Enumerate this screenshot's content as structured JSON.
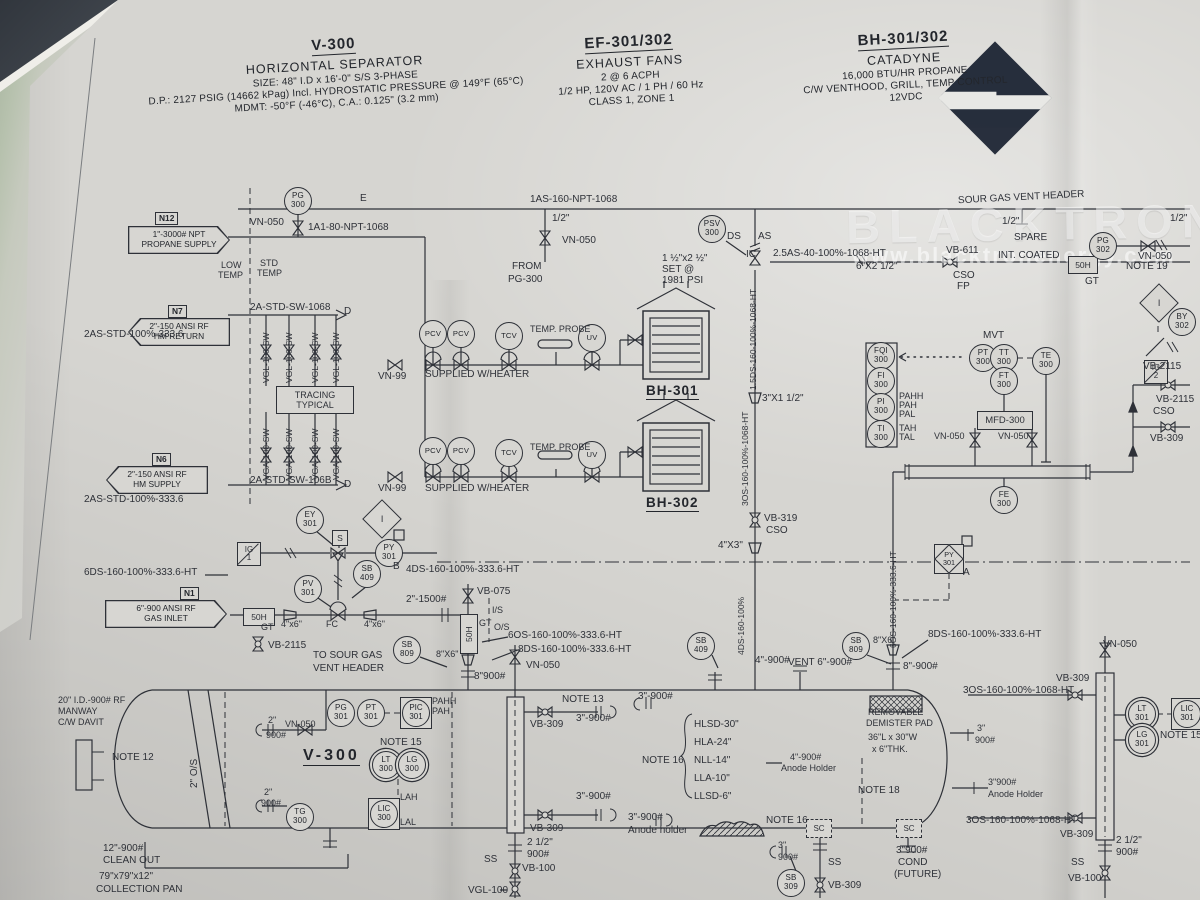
{
  "watermark": {
    "brand": "BLACKTRON",
    "url": "www.blacktronenergy.com"
  },
  "title_blocks": {
    "v300": {
      "tag": "V-300",
      "name": "HORIZONTAL SEPARATOR",
      "l1": "SIZE: 48\" I.D x 16'-0\" S/S 3-PHASE",
      "l2": "D.P.: 2127 PSIG (14662 kPag) Incl. HYDROSTATIC PRESSURE @ 149°F (65°C)",
      "l3": "MDMT: -50°F (-46°C), C.A.: 0.125\" (3.2 mm)"
    },
    "ef": {
      "tag": "EF-301/302",
      "name": "EXHAUST FANS",
      "l1": "2 @ 6 ACPH",
      "l2": "1/2 HP, 120V AC / 1 PH / 60 Hz",
      "l3": "CLASS 1, ZONE 1"
    },
    "bh": {
      "tag": "BH-301/302",
      "name": "CATADYNE",
      "l1": "16,000 BTU/HR PROPANE",
      "l2": "C/W VENTHOOD, GRILL, TEMP CONTROL",
      "l3": "12VDC"
    }
  },
  "equipment": {
    "bh301": "BH-301",
    "bh302": "BH-302",
    "v300": "V-300",
    "tracing_l1": "TRACING",
    "tracing_l2": "TYPICAL",
    "mfd": "MFD-300",
    "strainer": "50H",
    "ig": "IG",
    "ig1": "1",
    "ig2": "2",
    "interlock": "I",
    "solenoid": "S",
    "sc": "SC"
  },
  "flags": [
    {
      "id": "N12",
      "l1": "1\"-3000# NPT",
      "l2": "PROPANE SUPPLY",
      "x": 128,
      "y": 226,
      "w": 102,
      "dir": "right",
      "bx": 155,
      "by": 212
    },
    {
      "id": "N7",
      "l1": "2\"-150 ANSI RF",
      "l2": "HM RETURN",
      "x": 128,
      "y": 318,
      "w": 102,
      "dir": "left",
      "bx": 168,
      "by": 305
    },
    {
      "id": "N6",
      "l1": "2\"-150 ANSI RF",
      "l2": "HM SUPPLY",
      "x": 106,
      "y": 466,
      "w": 102,
      "dir": "left",
      "bx": 152,
      "by": 453
    },
    {
      "id": "N1",
      "l1": "6\"-900 ANSI RF",
      "l2": "GAS INLET",
      "x": 105,
      "y": 600,
      "w": 122,
      "dir": "right",
      "bx": 180,
      "by": 587
    }
  ],
  "instruments": [
    {
      "t": "PG",
      "n": "300",
      "x": 298,
      "y": 201
    },
    {
      "t": "PSV",
      "n": "300",
      "x": 712,
      "y": 229
    },
    {
      "t": "PG",
      "n": "302",
      "x": 1103,
      "y": 246
    },
    {
      "t": "BY",
      "n": "302",
      "x": 1182,
      "y": 322
    },
    {
      "t": "PCV",
      "x": 433,
      "y": 334,
      "s": "c1"
    },
    {
      "t": "PCV",
      "x": 461,
      "y": 334,
      "s": "c1"
    },
    {
      "t": "TCV",
      "x": 509,
      "y": 336,
      "s": "c1"
    },
    {
      "t": "UV",
      "x": 592,
      "y": 338,
      "s": "c1"
    },
    {
      "t": "PCV",
      "x": 433,
      "y": 451,
      "s": "c1"
    },
    {
      "t": "PCV",
      "x": 461,
      "y": 451,
      "s": "c1"
    },
    {
      "t": "TCV",
      "x": 509,
      "y": 453,
      "s": "c1"
    },
    {
      "t": "UV",
      "x": 592,
      "y": 455,
      "s": "c1"
    },
    {
      "t": "PT",
      "n": "300",
      "x": 983,
      "y": 358
    },
    {
      "t": "TT",
      "n": "300",
      "x": 1004,
      "y": 358
    },
    {
      "t": "TE",
      "n": "300",
      "x": 1046,
      "y": 361
    },
    {
      "t": "FT",
      "n": "300",
      "x": 1004,
      "y": 381
    },
    {
      "t": "FQI",
      "n": "300",
      "x": 881,
      "y": 356
    },
    {
      "t": "FI",
      "n": "300",
      "x": 881,
      "y": 381
    },
    {
      "t": "PI",
      "n": "300",
      "x": 881,
      "y": 407
    },
    {
      "t": "TI",
      "n": "300",
      "x": 881,
      "y": 434
    },
    {
      "t": "FE",
      "n": "300",
      "x": 1004,
      "y": 500
    },
    {
      "t": "EY",
      "n": "301",
      "x": 310,
      "y": 520
    },
    {
      "t": "PY",
      "n": "301",
      "x": 389,
      "y": 553
    },
    {
      "t": "PV",
      "n": "301",
      "x": 308,
      "y": 589
    },
    {
      "t": "SB",
      "n": "409",
      "x": 367,
      "y": 574
    },
    {
      "t": "SB",
      "n": "809",
      "x": 407,
      "y": 650
    },
    {
      "t": "SB",
      "n": "409",
      "x": 701,
      "y": 646
    },
    {
      "t": "SB",
      "n": "809",
      "x": 856,
      "y": 646
    },
    {
      "t": "PG",
      "n": "301",
      "x": 341,
      "y": 713
    },
    {
      "t": "PT",
      "n": "301",
      "x": 371,
      "y": 713
    },
    {
      "t": "PIC",
      "n": "301",
      "x": 416,
      "y": 713,
      "s": "sq"
    },
    {
      "t": "LT",
      "n": "300",
      "x": 386,
      "y": 765,
      "s": "dd"
    },
    {
      "t": "LG",
      "n": "300",
      "x": 412,
      "y": 765,
      "s": "dd"
    },
    {
      "t": "LIC",
      "n": "300",
      "x": 384,
      "y": 814,
      "s": "sq"
    },
    {
      "t": "TG",
      "n": "300",
      "x": 300,
      "y": 817
    },
    {
      "t": "SB",
      "n": "309",
      "x": 791,
      "y": 883
    },
    {
      "t": "LT",
      "n": "301",
      "x": 1142,
      "y": 714,
      "s": "dd"
    },
    {
      "t": "LG",
      "n": "301",
      "x": 1142,
      "y": 740,
      "s": "dd"
    },
    {
      "t": "LIC",
      "n": "301",
      "x": 1187,
      "y": 714,
      "s": "sq"
    },
    {
      "t": "PY",
      "n": "301",
      "x": 949,
      "y": 559,
      "s": "dm"
    }
  ],
  "labels": [
    {
      "t": "1AS-160-NPT-1068",
      "x": 530,
      "y": 195
    },
    {
      "t": "SOUR GAS VENT HEADER",
      "x": 958,
      "y": 193,
      "r": -3
    },
    {
      "t": "1/2\"",
      "x": 552,
      "y": 214
    },
    {
      "t": "VN-050",
      "x": 562,
      "y": 236
    },
    {
      "t": "FROM",
      "x": 512,
      "y": 262
    },
    {
      "t": "PG-300",
      "x": 508,
      "y": 275
    },
    {
      "t": "E",
      "x": 360,
      "y": 194
    },
    {
      "t": "1/2\"",
      "x": 1002,
      "y": 217
    },
    {
      "t": "SPARE",
      "x": 1014,
      "y": 233
    },
    {
      "t": "1/2\"",
      "x": 1170,
      "y": 214
    },
    {
      "t": "VN-050",
      "x": 1138,
      "y": 252
    },
    {
      "t": "DS",
      "x": 727,
      "y": 232
    },
    {
      "t": "AS",
      "x": 758,
      "y": 232
    },
    {
      "t": "IC",
      "x": 746,
      "y": 250
    },
    {
      "t": "1 ½\"x2 ½\"",
      "x": 662,
      "y": 254
    },
    {
      "t": "SET @",
      "x": 662,
      "y": 265
    },
    {
      "t": "1981 PSI",
      "x": 662,
      "y": 276
    },
    {
      "t": "2.5AS-40-100%-1068-HT",
      "x": 773,
      "y": 249
    },
    {
      "t": "6\"X2 1/2\"",
      "x": 856,
      "y": 262
    },
    {
      "t": "VB-611",
      "x": 946,
      "y": 246
    },
    {
      "t": "CSO",
      "x": 953,
      "y": 271
    },
    {
      "t": "FP",
      "x": 957,
      "y": 282
    },
    {
      "t": "INT. COATED",
      "x": 998,
      "y": 251
    },
    {
      "t": "GT",
      "x": 1085,
      "y": 277
    },
    {
      "t": "NOTE 19",
      "x": 1126,
      "y": 262
    },
    {
      "t": "VN-050",
      "x": 250,
      "y": 218
    },
    {
      "t": "1A1-80-NPT-1068",
      "x": 308,
      "y": 223
    },
    {
      "t": "LOW",
      "x": 221,
      "y": 261,
      "f": 9
    },
    {
      "t": "TEMP",
      "x": 218,
      "y": 271,
      "f": 9
    },
    {
      "t": "STD",
      "x": 260,
      "y": 259,
      "f": 9
    },
    {
      "t": "TEMP",
      "x": 257,
      "y": 269,
      "f": 9
    },
    {
      "t": "2A-STD-SW-1068",
      "x": 250,
      "y": 303
    },
    {
      "t": "D",
      "x": 344,
      "y": 307
    },
    {
      "t": "2AS-STD-100%-333.6",
      "x": 84,
      "y": 330
    },
    {
      "t": "VGL-100-SW",
      "x": 262,
      "y": 383,
      "r": -90,
      "f": 8.5
    },
    {
      "t": "VGL-100-SW",
      "x": 285,
      "y": 383,
      "r": -90,
      "f": 8.5
    },
    {
      "t": "VGL-100-SW",
      "x": 311,
      "y": 383,
      "r": -90,
      "f": 8.5
    },
    {
      "t": "VGL-100-SW",
      "x": 332,
      "y": 383,
      "r": -90,
      "f": 8.5
    },
    {
      "t": "VGA-100-SW",
      "x": 262,
      "y": 480,
      "r": -90,
      "f": 8.5
    },
    {
      "t": "VGA-100-SW",
      "x": 285,
      "y": 480,
      "r": -90,
      "f": 8.5
    },
    {
      "t": "VGA-100-SW",
      "x": 311,
      "y": 480,
      "r": -90,
      "f": 8.5
    },
    {
      "t": "VGA-100-SW",
      "x": 332,
      "y": 480,
      "r": -90,
      "f": 8.5
    },
    {
      "t": "2A-STD-SW-106B",
      "x": 250,
      "y": 476
    },
    {
      "t": "D",
      "x": 344,
      "y": 480
    },
    {
      "t": "2AS-STD-100%-333.6",
      "x": 84,
      "y": 495
    },
    {
      "t": "VN-99",
      "x": 378,
      "y": 372
    },
    {
      "t": "SUPPLIED W/HEATER",
      "x": 425,
      "y": 370
    },
    {
      "t": "TEMP. PROBE",
      "x": 530,
      "y": 325,
      "f": 9
    },
    {
      "t": "VN-99",
      "x": 378,
      "y": 484
    },
    {
      "t": "SUPPLIED W/HEATER",
      "x": 425,
      "y": 484
    },
    {
      "t": "TEMP. PROBE",
      "x": 530,
      "y": 443,
      "f": 9
    },
    {
      "t": "3\"X1 1/2\"",
      "x": 762,
      "y": 394
    },
    {
      "t": "1.5DS-160-100%-1068-HT",
      "x": 749,
      "y": 390,
      "r": -90,
      "f": 8.5
    },
    {
      "t": "3OS-160-100%-1068-HT",
      "x": 741,
      "y": 506,
      "r": -90,
      "f": 8.5
    },
    {
      "t": "VB-319",
      "x": 764,
      "y": 514
    },
    {
      "t": "CSO",
      "x": 766,
      "y": 526
    },
    {
      "t": "4\"X3\"",
      "x": 718,
      "y": 541
    },
    {
      "t": "MVT",
      "x": 983,
      "y": 331
    },
    {
      "t": "PAHH",
      "x": 899,
      "y": 392,
      "f": 9
    },
    {
      "t": "PAH",
      "x": 899,
      "y": 401,
      "f": 9
    },
    {
      "t": "PAL",
      "x": 899,
      "y": 410,
      "f": 9
    },
    {
      "t": "TAH",
      "x": 899,
      "y": 424,
      "f": 9
    },
    {
      "t": "TAL",
      "x": 899,
      "y": 433,
      "f": 9
    },
    {
      "t": "VN-050",
      "x": 934,
      "y": 432,
      "f": 9
    },
    {
      "t": "VN-050",
      "x": 998,
      "y": 432,
      "f": 9
    },
    {
      "t": "VB-2115",
      "x": 1143,
      "y": 362
    },
    {
      "t": "VB-2115",
      "x": 1156,
      "y": 395
    },
    {
      "t": "CSO",
      "x": 1153,
      "y": 407
    },
    {
      "t": "VB-309",
      "x": 1150,
      "y": 434
    },
    {
      "t": "6DS-160-100%-333.6-HT",
      "x": 84,
      "y": 568
    },
    {
      "t": "4DS-160-100%-333.6-HT",
      "x": 406,
      "y": 565
    },
    {
      "t": "B",
      "x": 393,
      "y": 562
    },
    {
      "t": "A",
      "x": 963,
      "y": 568
    },
    {
      "t": "2\"-1500#",
      "x": 406,
      "y": 595
    },
    {
      "t": "GT",
      "x": 261,
      "y": 623,
      "f": 9
    },
    {
      "t": "4\"x6\"",
      "x": 281,
      "y": 620,
      "f": 9
    },
    {
      "t": "FC",
      "x": 326,
      "y": 620,
      "f": 9
    },
    {
      "t": "4\"x6\"",
      "x": 364,
      "y": 620,
      "f": 9
    },
    {
      "t": "VB-2115",
      "x": 268,
      "y": 641
    },
    {
      "t": "VB-075",
      "x": 477,
      "y": 587
    },
    {
      "t": "I/S",
      "x": 492,
      "y": 606,
      "f": 9
    },
    {
      "t": "O/S",
      "x": 494,
      "y": 623,
      "f": 9
    },
    {
      "t": "GT",
      "x": 479,
      "y": 619,
      "f": 9
    },
    {
      "t": "6OS-160-100%-333.6-HT",
      "x": 508,
      "y": 631
    },
    {
      "t": "8DS-160-100%-333.6-HT",
      "x": 518,
      "y": 645
    },
    {
      "t": "8\"X6\"",
      "x": 436,
      "y": 650,
      "f": 9
    },
    {
      "t": "VN-050",
      "x": 526,
      "y": 661
    },
    {
      "t": "8\"900#",
      "x": 474,
      "y": 672
    },
    {
      "t": "TO SOUR GAS",
      "x": 313,
      "y": 651
    },
    {
      "t": "VENT HEADER",
      "x": 313,
      "y": 664
    },
    {
      "t": "4DS-160-100%",
      "x": 737,
      "y": 655,
      "r": -90,
      "f": 8.5
    },
    {
      "t": "4\"-900#",
      "x": 755,
      "y": 656
    },
    {
      "t": "VENT 6\"-900#",
      "x": 788,
      "y": 658
    },
    {
      "t": "8\"X6\"",
      "x": 873,
      "y": 636,
      "f": 9
    },
    {
      "t": "8\"-900#",
      "x": 903,
      "y": 662
    },
    {
      "t": "8DS-160-100%-333.6-HT",
      "x": 928,
      "y": 630
    },
    {
      "t": "6OS-160-100%-333.6-HT",
      "x": 889,
      "y": 648,
      "r": -90,
      "f": 8.5
    },
    {
      "t": "3OS-160-100%-1068-HT",
      "x": 963,
      "y": 686
    },
    {
      "t": "VB-309",
      "x": 1056,
      "y": 674
    },
    {
      "t": "3OS-160-100%-1068-HT",
      "x": 966,
      "y": 816
    },
    {
      "t": "VB-309",
      "x": 1060,
      "y": 830
    },
    {
      "t": "20\" I.D.-900# RF",
      "x": 58,
      "y": 696,
      "f": 9
    },
    {
      "t": "MANWAY",
      "x": 58,
      "y": 707,
      "f": 9
    },
    {
      "t": "C/W DAVIT",
      "x": 58,
      "y": 718,
      "f": 9
    },
    {
      "t": "NOTE 12",
      "x": 112,
      "y": 753
    },
    {
      "t": "2\" O/S",
      "x": 190,
      "y": 788,
      "r": -90
    },
    {
      "t": "12\"-900#",
      "x": 103,
      "y": 844
    },
    {
      "t": "CLEAN OUT",
      "x": 103,
      "y": 856
    },
    {
      "t": "79\"x79\"x12\"",
      "x": 99,
      "y": 872
    },
    {
      "t": "COLLECTION PAN",
      "x": 96,
      "y": 885
    },
    {
      "t": "2\"",
      "x": 268,
      "y": 716,
      "f": 9
    },
    {
      "t": "VN-050",
      "x": 285,
      "y": 720,
      "f": 9
    },
    {
      "t": "900#",
      "x": 266,
      "y": 731,
      "f": 9
    },
    {
      "t": "PAHH",
      "x": 432,
      "y": 697,
      "f": 9
    },
    {
      "t": "PAH",
      "x": 432,
      "y": 707,
      "f": 9
    },
    {
      "t": "NOTE 15",
      "x": 380,
      "y": 738
    },
    {
      "t": "LAH",
      "x": 400,
      "y": 793,
      "f": 9
    },
    {
      "t": "LAL",
      "x": 400,
      "y": 818,
      "f": 9
    },
    {
      "t": "2\"",
      "x": 264,
      "y": 788,
      "f": 9
    },
    {
      "t": "900#",
      "x": 261,
      "y": 799,
      "f": 9
    },
    {
      "t": "NOTE 13",
      "x": 562,
      "y": 695
    },
    {
      "t": "3\"-900#",
      "x": 576,
      "y": 714
    },
    {
      "t": "VB-309",
      "x": 530,
      "y": 720
    },
    {
      "t": "3\"-900#",
      "x": 638,
      "y": 692
    },
    {
      "t": "NOTE 16",
      "x": 642,
      "y": 756
    },
    {
      "t": "HLSD-30\"",
      "x": 694,
      "y": 720
    },
    {
      "t": "HLA-24\"",
      "x": 694,
      "y": 738
    },
    {
      "t": "NLL-14\"",
      "x": 694,
      "y": 756
    },
    {
      "t": "LLA-10\"",
      "x": 694,
      "y": 774
    },
    {
      "t": "LLSD-6\"",
      "x": 694,
      "y": 792
    },
    {
      "t": "3\"-900#",
      "x": 576,
      "y": 792
    },
    {
      "t": "VB-309",
      "x": 530,
      "y": 824
    },
    {
      "t": "3\"-900#",
      "x": 628,
      "y": 813
    },
    {
      "t": "Anode holder",
      "x": 628,
      "y": 826
    },
    {
      "t": "NOTE 16",
      "x": 766,
      "y": 816
    },
    {
      "t": "4\"-900#",
      "x": 790,
      "y": 753,
      "f": 9
    },
    {
      "t": "Anode Holder",
      "x": 781,
      "y": 764,
      "f": 9
    },
    {
      "t": "2 1/2\"",
      "x": 527,
      "y": 838
    },
    {
      "t": "900#",
      "x": 527,
      "y": 850
    },
    {
      "t": "SS",
      "x": 484,
      "y": 855
    },
    {
      "t": "VB-100",
      "x": 522,
      "y": 864
    },
    {
      "t": "VGL-100",
      "x": 468,
      "y": 886
    },
    {
      "t": "3\"",
      "x": 778,
      "y": 841,
      "f": 9
    },
    {
      "t": "900#",
      "x": 778,
      "y": 853,
      "f": 9
    },
    {
      "t": "SS",
      "x": 828,
      "y": 858
    },
    {
      "t": "VB-309",
      "x": 828,
      "y": 881
    },
    {
      "t": "3\"900#",
      "x": 896,
      "y": 846
    },
    {
      "t": "COND",
      "x": 898,
      "y": 858
    },
    {
      "t": "(FUTURE)",
      "x": 894,
      "y": 870
    },
    {
      "t": "REMOVABLE",
      "x": 868,
      "y": 708,
      "f": 9
    },
    {
      "t": "DEMISTER PAD",
      "x": 866,
      "y": 719,
      "f": 9
    },
    {
      "t": "36\"L x 30\"W",
      "x": 868,
      "y": 733,
      "f": 9
    },
    {
      "t": "x 6\"THK.",
      "x": 872,
      "y": 745,
      "f": 9
    },
    {
      "t": "NOTE 18",
      "x": 858,
      "y": 786
    },
    {
      "t": "3\"",
      "x": 977,
      "y": 724,
      "f": 9
    },
    {
      "t": "900#",
      "x": 975,
      "y": 736,
      "f": 9
    },
    {
      "t": "3\"900#",
      "x": 988,
      "y": 778,
      "f": 9
    },
    {
      "t": "Anode Holder",
      "x": 988,
      "y": 790,
      "f": 9
    },
    {
      "t": "VN-050",
      "x": 1103,
      "y": 640
    },
    {
      "t": "NOTE 15",
      "x": 1160,
      "y": 731
    },
    {
      "t": "2 1/2\"",
      "x": 1116,
      "y": 836
    },
    {
      "t": "900#",
      "x": 1116,
      "y": 848
    },
    {
      "t": "SS",
      "x": 1071,
      "y": 858
    },
    {
      "t": "VB-100",
      "x": 1068,
      "y": 874
    }
  ]
}
